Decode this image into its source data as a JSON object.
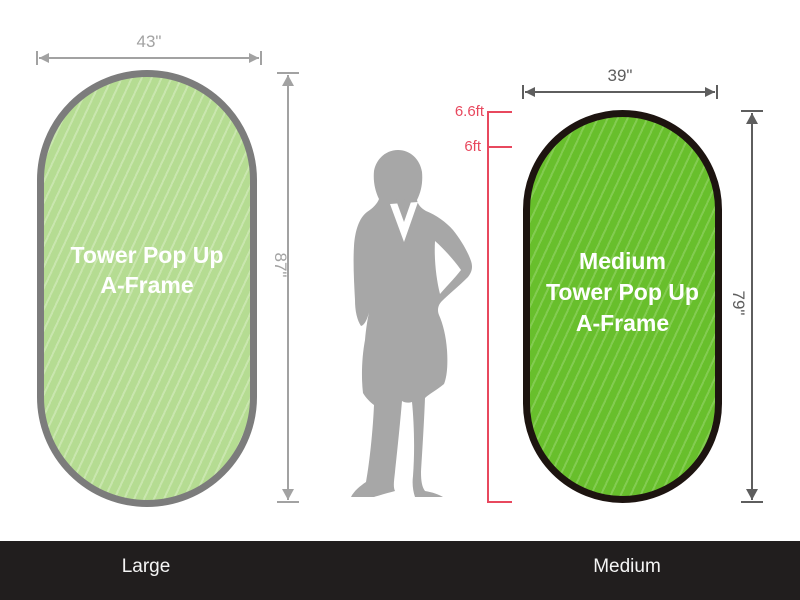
{
  "large_display": {
    "name_line1": "Tower Pop Up",
    "name_line2": "A-Frame",
    "width_dim": "43\"",
    "height_dim": "87\"",
    "footer_label": "Large"
  },
  "medium_display": {
    "name_line1": "Medium",
    "name_line2": "Tower Pop Up",
    "name_line3": "A-Frame",
    "width_dim": "39\"",
    "height_dim": "79\"",
    "footer_label": "Medium"
  },
  "person_scale": {
    "height_mark_top": "6.6ft",
    "height_mark_bottom": "6ft"
  },
  "colors": {
    "large_fill": "#b5dc92",
    "large_stripe": "#c9e6ae",
    "large_border": "#7c7c7c",
    "medium_fill": "#68bf2c",
    "medium_stripe": "#83cc51",
    "medium_border": "#1d1410",
    "dim_light": "#a2a2a2",
    "dim_dark": "#5e5e5e",
    "ruler_red": "#e8485e",
    "silhouette_gray": "#a7a7a7",
    "footer_bg": "#211e1e",
    "footer_text": "#f5f5f5"
  }
}
